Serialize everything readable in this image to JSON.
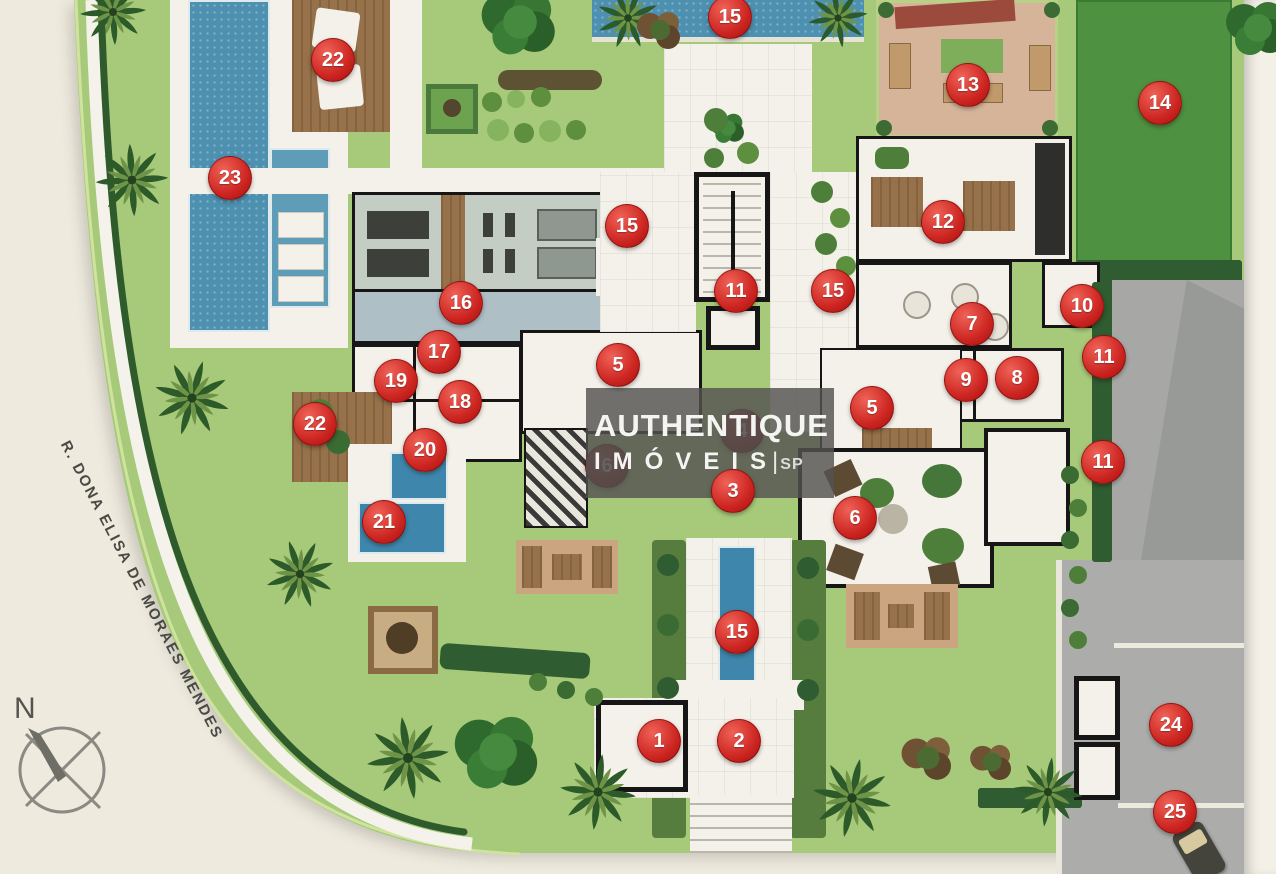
{
  "plan": {
    "watermark": {
      "line1": "AUTHENTIQUE",
      "line2": "IMÓVEIS",
      "divider": "|",
      "region": "SP"
    },
    "street_label": "R. DONA ELISA DE MORAES MENDES",
    "compass_label": "N",
    "colors": {
      "red": "#cc2420",
      "lawn": "#a6ca79",
      "lawn_dark": "#8fb963",
      "field": "#4e9140",
      "pool": "#4d90b0",
      "hedge": "#2f5c30",
      "wood": "#96714a",
      "paving": "#a7a7a5",
      "floor": "#f3f1e9",
      "wall": "#161616",
      "bg": "#eeeade"
    },
    "markers": [
      {
        "n": "15",
        "x": 730,
        "y": 17
      },
      {
        "n": "22",
        "x": 333,
        "y": 60
      },
      {
        "n": "13",
        "x": 968,
        "y": 85
      },
      {
        "n": "14",
        "x": 1160,
        "y": 103
      },
      {
        "n": "23",
        "x": 230,
        "y": 178
      },
      {
        "n": "12",
        "x": 943,
        "y": 222
      },
      {
        "n": "15",
        "x": 627,
        "y": 226
      },
      {
        "n": "11",
        "x": 736,
        "y": 291
      },
      {
        "n": "15",
        "x": 833,
        "y": 291
      },
      {
        "n": "16",
        "x": 461,
        "y": 303
      },
      {
        "n": "10",
        "x": 1082,
        "y": 306
      },
      {
        "n": "7",
        "x": 972,
        "y": 324
      },
      {
        "n": "17",
        "x": 439,
        "y": 352
      },
      {
        "n": "11",
        "x": 1104,
        "y": 357
      },
      {
        "n": "5",
        "x": 618,
        "y": 365
      },
      {
        "n": "9",
        "x": 966,
        "y": 380
      },
      {
        "n": "8",
        "x": 1017,
        "y": 378
      },
      {
        "n": "19",
        "x": 396,
        "y": 381
      },
      {
        "n": "18",
        "x": 460,
        "y": 402
      },
      {
        "n": "5",
        "x": 872,
        "y": 408
      },
      {
        "n": "22",
        "x": 315,
        "y": 424
      },
      {
        "n": "4",
        "x": 742,
        "y": 431,
        "dim": true
      },
      {
        "n": "20",
        "x": 425,
        "y": 450
      },
      {
        "n": "11",
        "x": 1103,
        "y": 462
      },
      {
        "n": "6",
        "x": 607,
        "y": 466,
        "dim": true
      },
      {
        "n": "3",
        "x": 733,
        "y": 491
      },
      {
        "n": "6",
        "x": 855,
        "y": 518
      },
      {
        "n": "21",
        "x": 384,
        "y": 522
      },
      {
        "n": "15",
        "x": 737,
        "y": 632
      },
      {
        "n": "24",
        "x": 1171,
        "y": 725
      },
      {
        "n": "1",
        "x": 659,
        "y": 741
      },
      {
        "n": "2",
        "x": 739,
        "y": 741
      },
      {
        "n": "25",
        "x": 1175,
        "y": 812
      }
    ]
  }
}
